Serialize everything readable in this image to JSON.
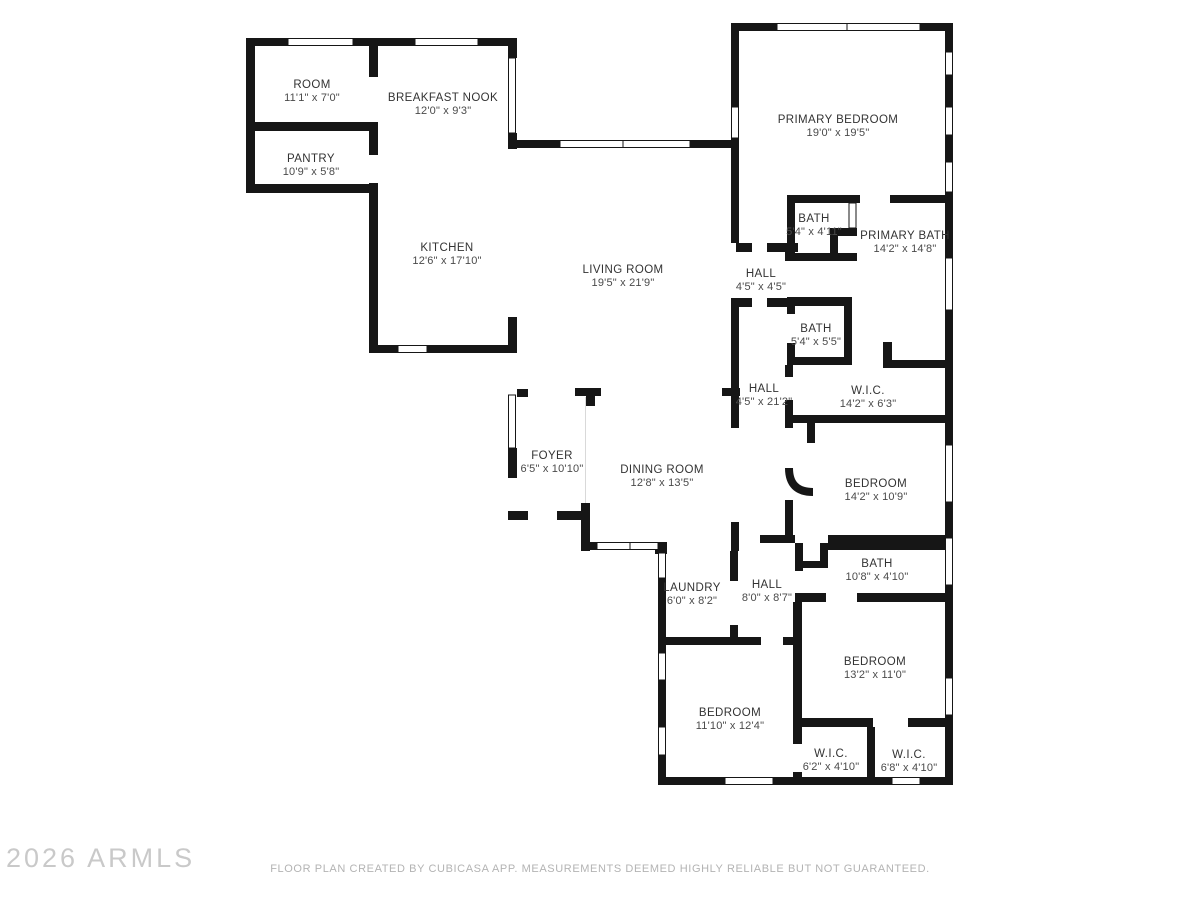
{
  "plan": {
    "wall_color": "#161616",
    "background_color": "#ffffff",
    "label_color": "#333333",
    "dimension_color": "#4a4a4a"
  },
  "rooms": [
    {
      "name": "ROOM",
      "dims": "11'1\" x 7'0\""
    },
    {
      "name": "BREAKFAST NOOK",
      "dims": "12'0\" x 9'3\""
    },
    {
      "name": "PANTRY",
      "dims": "10'9\" x 5'8\""
    },
    {
      "name": "KITCHEN",
      "dims": "12'6\" x 17'10\""
    },
    {
      "name": "LIVING ROOM",
      "dims": "19'5\" x 21'9\""
    },
    {
      "name": "PRIMARY BEDROOM",
      "dims": "19'0\" x 19'5\""
    },
    {
      "name": "BATH",
      "dims": "5'4\" x 4'11\""
    },
    {
      "name": "PRIMARY BATH",
      "dims": "14'2\" x 14'8\""
    },
    {
      "name": "HALL",
      "dims": "4'5\" x 4'5\""
    },
    {
      "name": "BATH",
      "dims": "5'4\" x 5'5\""
    },
    {
      "name": "HALL",
      "dims": "4'5\" x 21'2\""
    },
    {
      "name": "W.I.C.",
      "dims": "14'2\" x 6'3\""
    },
    {
      "name": "FOYER",
      "dims": "6'5\" x 10'10\""
    },
    {
      "name": "DINING ROOM",
      "dims": "12'8\" x 13'5\""
    },
    {
      "name": "BEDROOM",
      "dims": "14'2\" x 10'9\""
    },
    {
      "name": "LAUNDRY",
      "dims": "6'0\" x 8'2\""
    },
    {
      "name": "HALL",
      "dims": "8'0\" x 8'7\""
    },
    {
      "name": "BATH",
      "dims": "10'8\" x 4'10\""
    },
    {
      "name": "BEDROOM",
      "dims": "11'10\" x 12'4\""
    },
    {
      "name": "BEDROOM",
      "dims": "13'2\" x 11'0\""
    },
    {
      "name": "W.I.C.",
      "dims": "6'2\" x 4'10\""
    },
    {
      "name": "W.I.C.",
      "dims": "6'8\" x 4'10\""
    }
  ],
  "footer": {
    "watermark": "2026 ARMLS",
    "disclaimer": "FLOOR PLAN CREATED BY CUBICASA APP. MEASUREMENTS DEEMED HIGHLY RELIABLE BUT NOT GUARANTEED."
  }
}
